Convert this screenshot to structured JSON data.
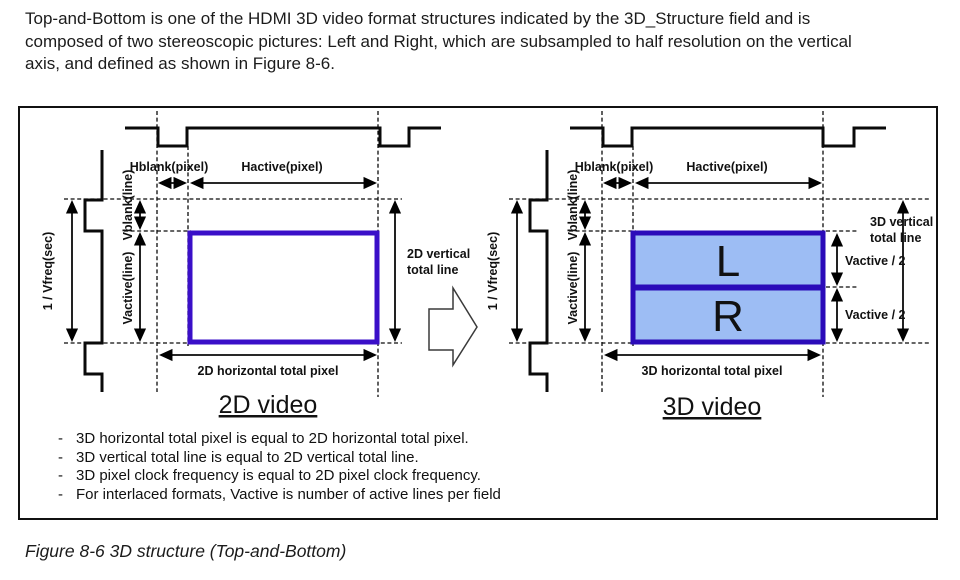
{
  "intro": "Top-and-Bottom is one of the HDMI 3D video format structures indicated by the 3D_Structure field and is composed of two stereoscopic pictures: Left and Right, which are subsampled to half resolution on the vertical axis, and defined as shown in Figure 8-6.",
  "figure": {
    "caption": "Figure 8-6 3D structure (Top-and-Bottom)",
    "bullet_char": "-",
    "notes": [
      "3D horizontal total pixel is equal to 2D horizontal total pixel.",
      "3D vertical total line is equal to 2D vertical total line.",
      "3D pixel clock frequency is equal to 2D pixel clock frequency.",
      "For interlaced formats, Vactive is number of active lines per field"
    ],
    "d2": {
      "title": "2D video",
      "hblank": "Hblank(pixel)",
      "hactive": "Hactive(pixel)",
      "vblank": "Vblank(line)",
      "vactive": "Vactive(line)",
      "vfreq": "1 / Vfreq(sec)",
      "v_total_1": "2D vertical",
      "v_total_2": "total line",
      "h_total": "2D horizontal total pixel"
    },
    "d3": {
      "title": "3D video",
      "hblank": "Hblank(pixel)",
      "hactive": "Hactive(pixel)",
      "vblank": "Vblank(line)",
      "vactive": "Vactive(line)",
      "vfreq": "1 / Vfreq(sec)",
      "v_total_1": "3D vertical",
      "v_total_2": "total line",
      "h_total": "3D horizontal total pixel",
      "left": "L",
      "right": "R",
      "vactive_half_top": "Vactive / 2",
      "vactive_half_bottom": "Vactive / 2"
    }
  },
  "colors": {
    "box_stroke_2d": "#3a0fc8",
    "box_stroke_3d": "#2b0bb9",
    "box_fill_3d": "#9dbdf4"
  }
}
